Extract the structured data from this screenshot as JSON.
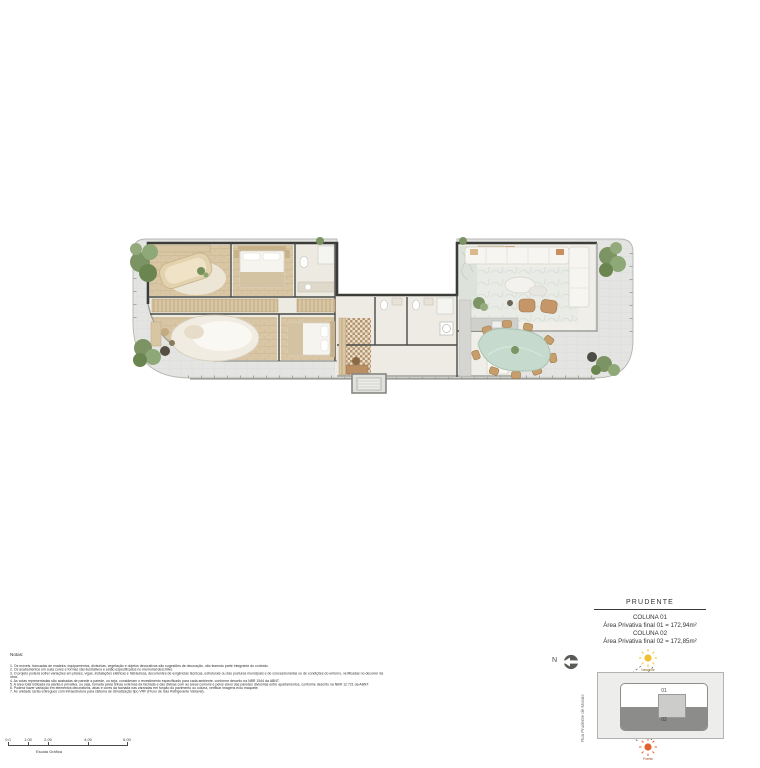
{
  "title_block": {
    "project": "PRUDENTE",
    "col1_label": "COLUNA 01",
    "col1_area": "Área Privativa final 01 = 172,94m²",
    "col2_label": "COLUNA 02",
    "col2_area": "Área Privativa final 02 = 172,85m²"
  },
  "notes": {
    "heading": "Notas:",
    "items": [
      "1. Os móveis, bancadas de madeira, equipamentos, divisórias, vegetação e objetos decorativos são sugestões de decoração, não fazendo parte integrante do contrato.",
      "2. Os acabamentos em suas cores e formas são ilustrativos e estão especificados no memorial descritivo.",
      "3. O projeto poderá sofrer variações em pilares, vigas, instalações elétricas e hidráulicas, decorrentes de exigências técnicas, estruturais ou das posturas municipais e de concessionárias ou de condições do entorno, verificadas no decorrer da obra.",
      "4. As cotas representadas são acabadas de parede a parede, ou seja, consideram o revestimento especificado para cada ambiente, conforme descrito na NBR 1544 da ABNT.",
      "5. A área total indicada na planta é privativa, ou seja, tomada pelas linhas externas da fachada e das divisas com as áreas comuns e pelos eixos das paredes divisórias entre apartamentos, conforme descrito na NBR 12.721 da ABNT.",
      "6. Poderá haver variação em elementos decorativos, abas e cores da fachada nas varandas em função do pavimento ou coluna, verificar imagens e/ou maquete.",
      "7. As unidade serão entregues com infraestrutura para sistema de climatização tipo VRF (Fluxo de Gás Refrigerante Variável)."
    ]
  },
  "scale_bar": {
    "ticks": [
      "0.0",
      "1,00",
      "2,00",
      "4,00",
      "6,00"
    ],
    "label": "Escala Gráfica"
  },
  "compass": {
    "letter": "N"
  },
  "key_plan": {
    "street": "Rua Prudente de Morais",
    "unit_top": "01",
    "unit_bottom": "02",
    "sun_top": "Nascente",
    "sun_bottom": "Poente"
  },
  "colors": {
    "deck": "#e4e5e2",
    "interior_floor": "#edeae2",
    "wood_floor": "#d9c6a4",
    "wall": "#3b3b37",
    "vegetation": "#7c9464",
    "dining_table": "#c6dbcd",
    "furniture_white": "#f6f5f1",
    "furniture_tan": "#c79d6b",
    "sun_rise": "#f0c030",
    "sun_set": "#e2622f",
    "keyplan_unit": "#8c8c8a"
  }
}
